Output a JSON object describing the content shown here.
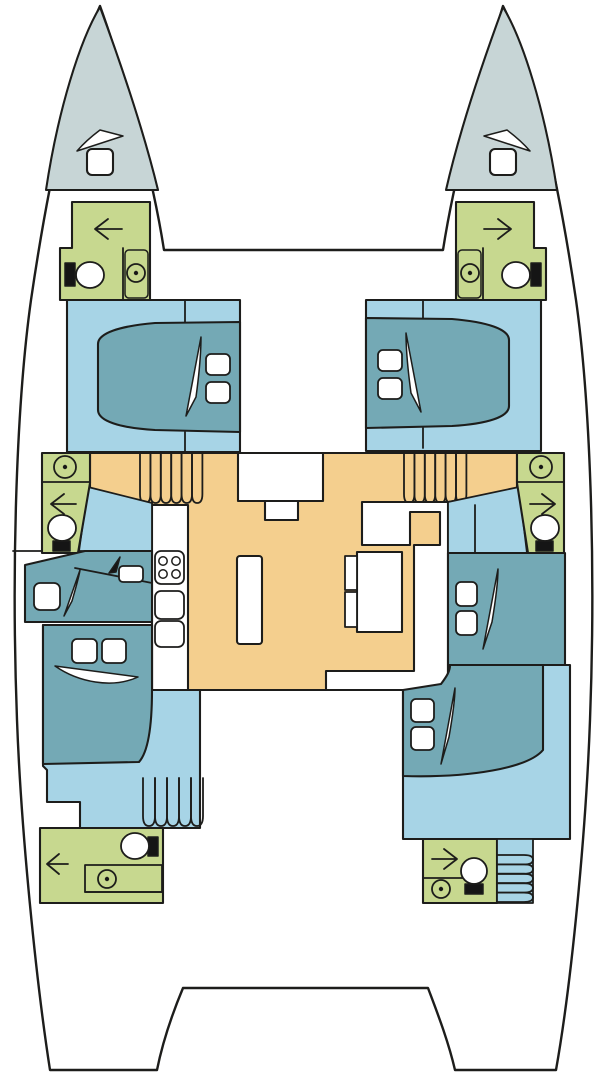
{
  "meta": {
    "title": "Catamaran yacht deck layout plan",
    "type": "floor-plan-diagram",
    "canvas": {
      "width": 606,
      "height": 1080
    }
  },
  "colors": {
    "page_bg": "#ffffff",
    "outline": "#1d1d1b",
    "hull_white": "#ffffff",
    "bow_locker": "#c7d5d6",
    "cabin_floor": "#a7d4e6",
    "bed_teal": "#74a9b5",
    "bathroom_green": "#c7d88f",
    "deck_orange": "#f4cf8e",
    "furniture_white": "#ffffff",
    "icon_black": "#151515"
  },
  "legend": {
    "bow_locker": "forepeak sail locker",
    "cabin_floor": "hull cabin floor",
    "bed_teal": "berth / bed",
    "bathroom_green": "head (bathroom)",
    "deck_orange": "salon & companionway deck"
  },
  "areas": {
    "port_bow_locker": "port forepeak locker with hatch",
    "starboard_bow_locker": "starboard forepeak locker with hatch",
    "port_forward_bathroom": "port forward head: toilet, sink, door",
    "starboard_forward_bathroom": "starboard forward head: toilet, sink, door",
    "port_forward_cabin": "port forward cabin, double berth with pillows",
    "starboard_forward_cabin": "starboard forward cabin, double berth with pillows",
    "salon": "main salon: galley counter, stove, sinks, island, dinette table and C-settee",
    "port_mid_bathroom": "port mid head: sink, door, toilet",
    "starboard_mid_bathroom": "starboard mid head: sink, door, toilet",
    "port_companionway": "port stairs from salon to hull",
    "starboard_companionway": "starboard stairs from salon to hull",
    "port_desk_area": "port hull vanity desk with stool",
    "port_aft_cabin": "port aft cabin, double berth with pillows, stairs",
    "starboard_mid_cabin": "starboard mid double berth with pillows",
    "starboard_aft_cabin": "starboard aft cabin, double berth with pillows",
    "port_aft_bathroom": "port aft head: toilet, sink, door",
    "starboard_aft_bathroom": "starboard aft head: toilet, sink, door, stairs"
  },
  "icons": {
    "toilet": "toilet-icon",
    "sink": "sink-icon",
    "door_arrow": "door-swing-arrow-icon",
    "stove": "stove-burners-icon",
    "hatch": "deck-hatch-icon",
    "reading_light": "reading-light-icon",
    "pillow": "pillow-icon",
    "stairs": "stairs-icon"
  }
}
